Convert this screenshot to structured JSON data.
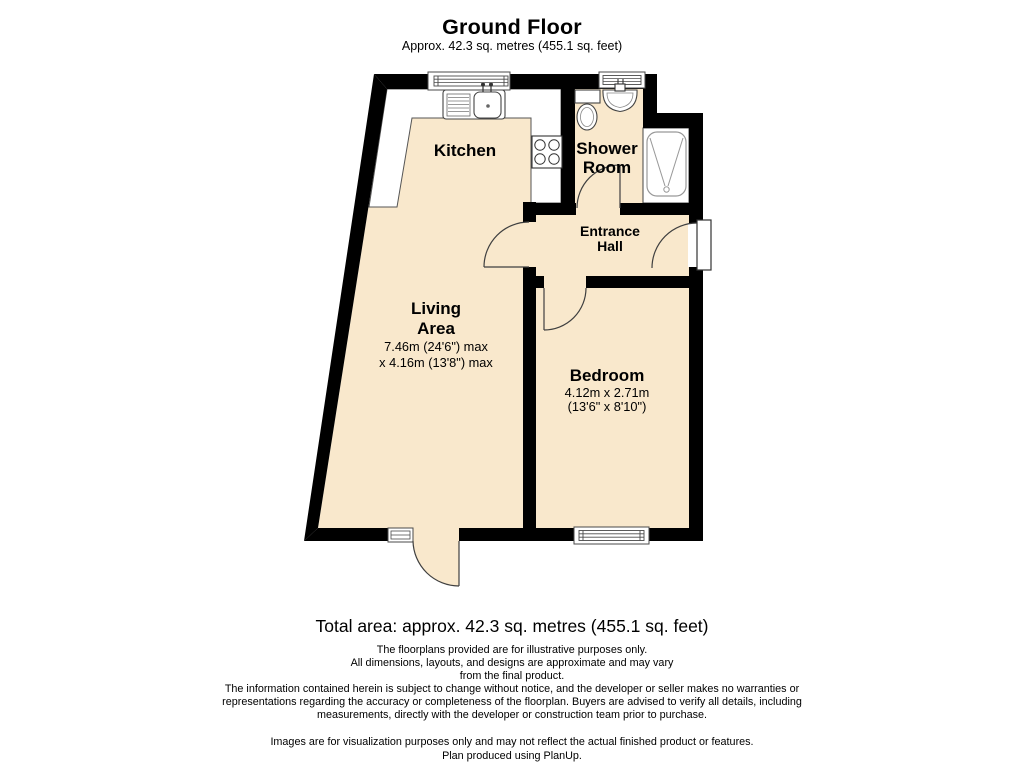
{
  "title": "Ground Floor",
  "subtitle": "Approx. 42.3 sq. metres (455.1 sq. feet)",
  "rooms": {
    "kitchen": {
      "label": "Kitchen"
    },
    "shower_room": {
      "label_line1": "Shower",
      "label_line2": "Room"
    },
    "entrance_hall": {
      "label_line1": "Entrance",
      "label_line2": "Hall"
    },
    "living_area": {
      "label_line1": "Living",
      "label_line2": "Area",
      "dim_line1": "7.46m (24'6\") max",
      "dim_line2": "x 4.16m (13'8\") max"
    },
    "bedroom": {
      "label": "Bedroom",
      "dim_line1": "4.12m x 2.71m",
      "dim_line2": "(13'6\" x 8'10\")"
    }
  },
  "total_area": "Total area: approx. 42.3 sq. metres (455.1 sq. feet)",
  "disclaimer": [
    "The floorplans provided are for illustrative purposes only.",
    "All dimensions, layouts, and designs are approximate and may vary",
    "from the final product.",
    "The information contained herein is subject to change without notice, and the developer or seller makes no warranties or",
    "representations regarding the accuracy or completeness of the floorplan. Buyers are advised to verify all details, including",
    "measurements, directly with the developer or construction team prior to purchase."
  ],
  "footer": [
    "Images are for visualization purposes only and may not reflect the actual finished product or features.",
    "Plan produced using PlanUp."
  ],
  "colors": {
    "floor": "#f9e8cc",
    "wall": "#000000"
  }
}
